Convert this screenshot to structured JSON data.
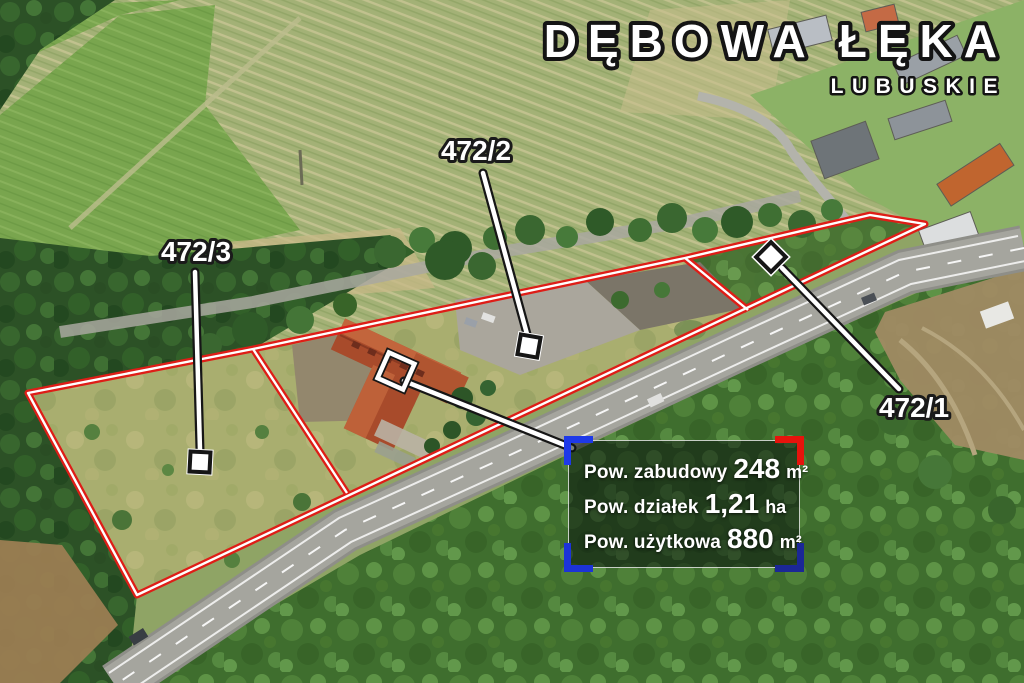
{
  "title": {
    "name": "DĘBOWA ŁĘKA",
    "region": "LUBUSKIE"
  },
  "plots": {
    "p1": {
      "id": "472/1"
    },
    "p2": {
      "id": "472/2"
    },
    "p3": {
      "id": "472/3"
    }
  },
  "info_box": {
    "rows": [
      {
        "label": "Pow. zabudowy",
        "value": "248",
        "unit": "m²"
      },
      {
        "label": "Pow. działek",
        "value": "1,21",
        "unit": "ha"
      },
      {
        "label": "Pow. użytkowa",
        "value": "880",
        "unit": "m²"
      }
    ]
  },
  "colors": {
    "boundary_red": "#de1d17",
    "bracket_blue_tl": "#1e39e8",
    "bracket_red_tr": "#e6130c",
    "bracket_blue_bl": "#1c33d8",
    "bracket_navy_br": "#1b2796",
    "label_text": "#ffffff"
  }
}
